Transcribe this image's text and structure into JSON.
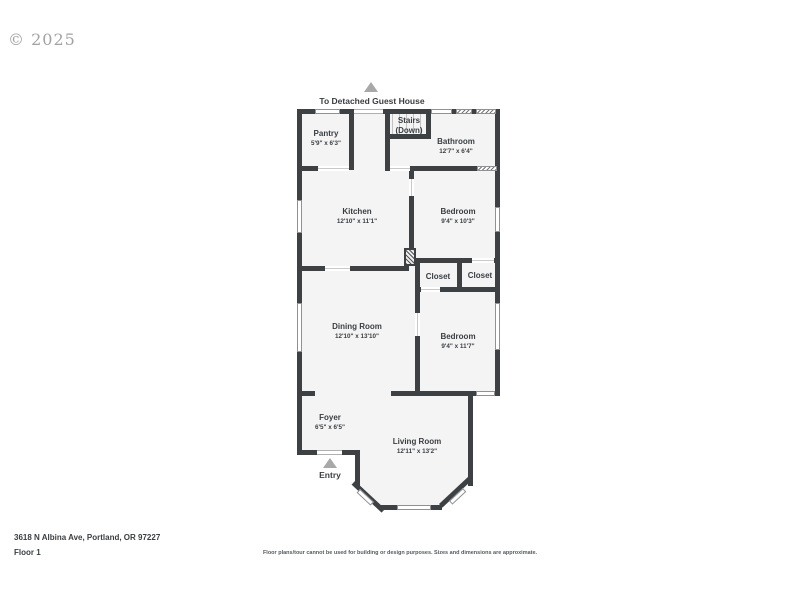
{
  "copyright": "© 2025",
  "plan": {
    "guest_house_label": "To Detached Guest House",
    "entry_label": "Entry",
    "rooms": [
      {
        "name": "Pantry",
        "dims": "5'9\" x 6'3\""
      },
      {
        "name": "Stairs",
        "dims": "(Down)"
      },
      {
        "name": "Bathroom",
        "dims": "12'7\" x 6'4\""
      },
      {
        "name": "Kitchen",
        "dims": "12'10\" x 11'1\""
      },
      {
        "name": "Bedroom",
        "dims": "9'4\" x 10'3\""
      },
      {
        "name": "Closet",
        "dims": ""
      },
      {
        "name": "Closet",
        "dims": ""
      },
      {
        "name": "Dining Room",
        "dims": "12'10\" x 13'10\""
      },
      {
        "name": "Bedroom",
        "dims": "9'4\" x 11'7\""
      },
      {
        "name": "Foyer",
        "dims": "6'5\" x 6'5\""
      },
      {
        "name": "Living Room",
        "dims": "12'11\" x 13'2\""
      }
    ]
  },
  "footer": {
    "address": "3618 N Albina Ave, Portland, OR 97227",
    "floor": "Floor 1",
    "disclaimer": "Floor plans/tour cannot be used for building or design purposes. Sizes and dimensions are approximate."
  },
  "colors": {
    "wall": "#3e4144",
    "room_fill": "#f4f4f5",
    "text": "#3a3e41",
    "arrow": "#a8a8a8"
  }
}
